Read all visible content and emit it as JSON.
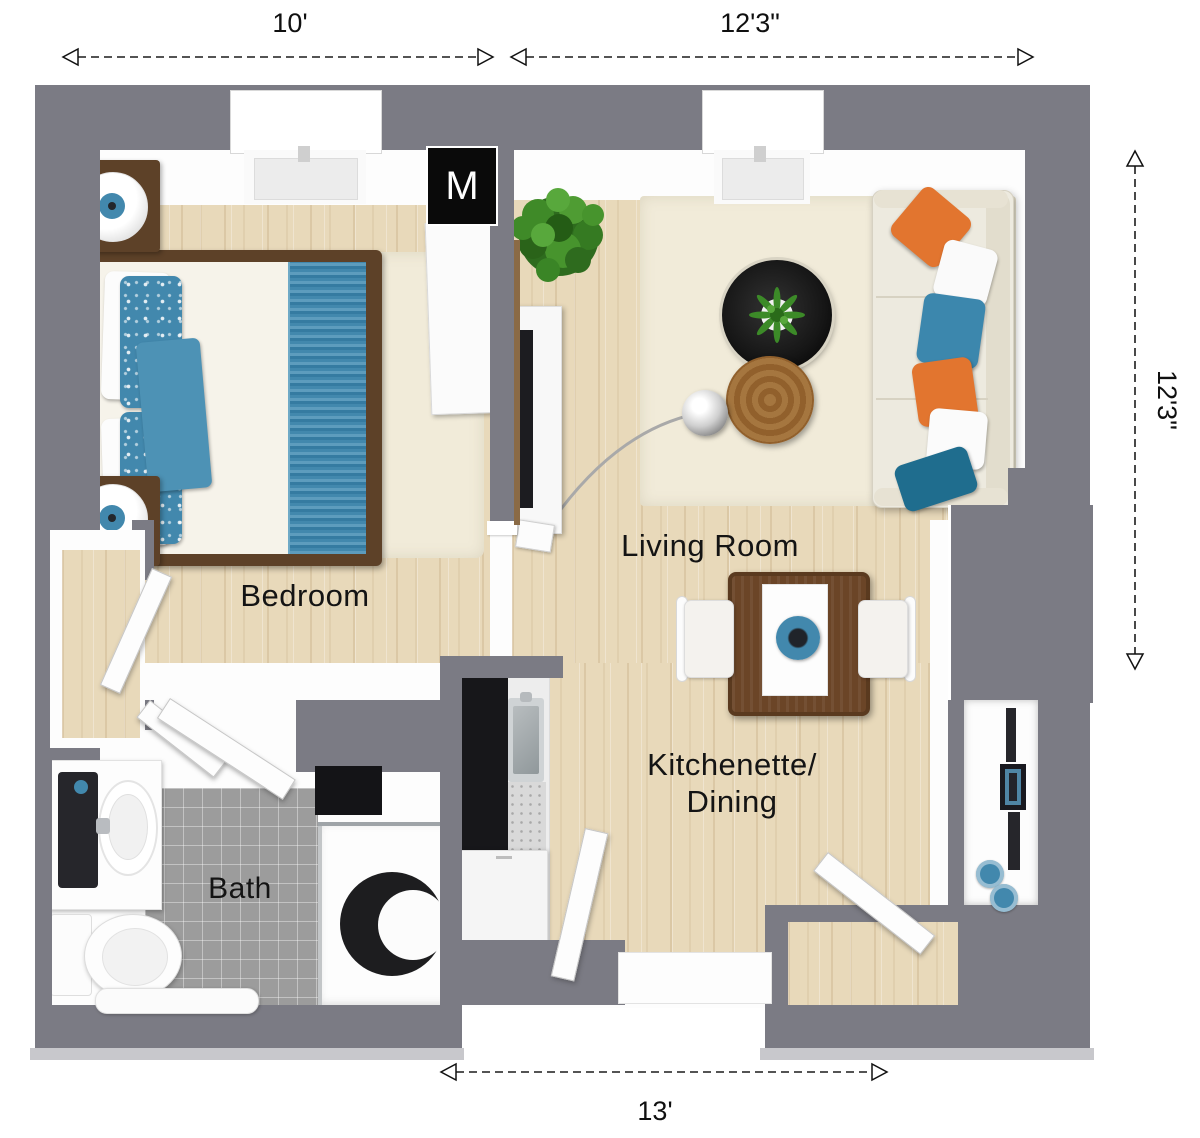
{
  "floorplan": {
    "rooms": [
      {
        "id": "bedroom",
        "label": "Bedroom"
      },
      {
        "id": "living_room",
        "label": "Living Room"
      },
      {
        "id": "kitchenette_dining",
        "lines": [
          "Kitchenette/",
          "Dining"
        ]
      },
      {
        "id": "bath",
        "label": "Bath"
      }
    ],
    "closet": {
      "label": "M"
    },
    "dimensions": {
      "top_left": "10'",
      "top_right": "12'3\"",
      "right_side": "12'3\"",
      "bottom": "13'"
    },
    "colors": {
      "wall": "#7b7b84",
      "wood": "#e8d9ba",
      "wood_dark": "#5d4128",
      "tile": "#9c9c9c",
      "rug": "#f1ebd9",
      "accent_blue": "#4288ad",
      "accent_orange": "#e2752f",
      "sofa": "#edeadf",
      "table_black": "#161616",
      "table_wood": "#9b6a33"
    }
  }
}
